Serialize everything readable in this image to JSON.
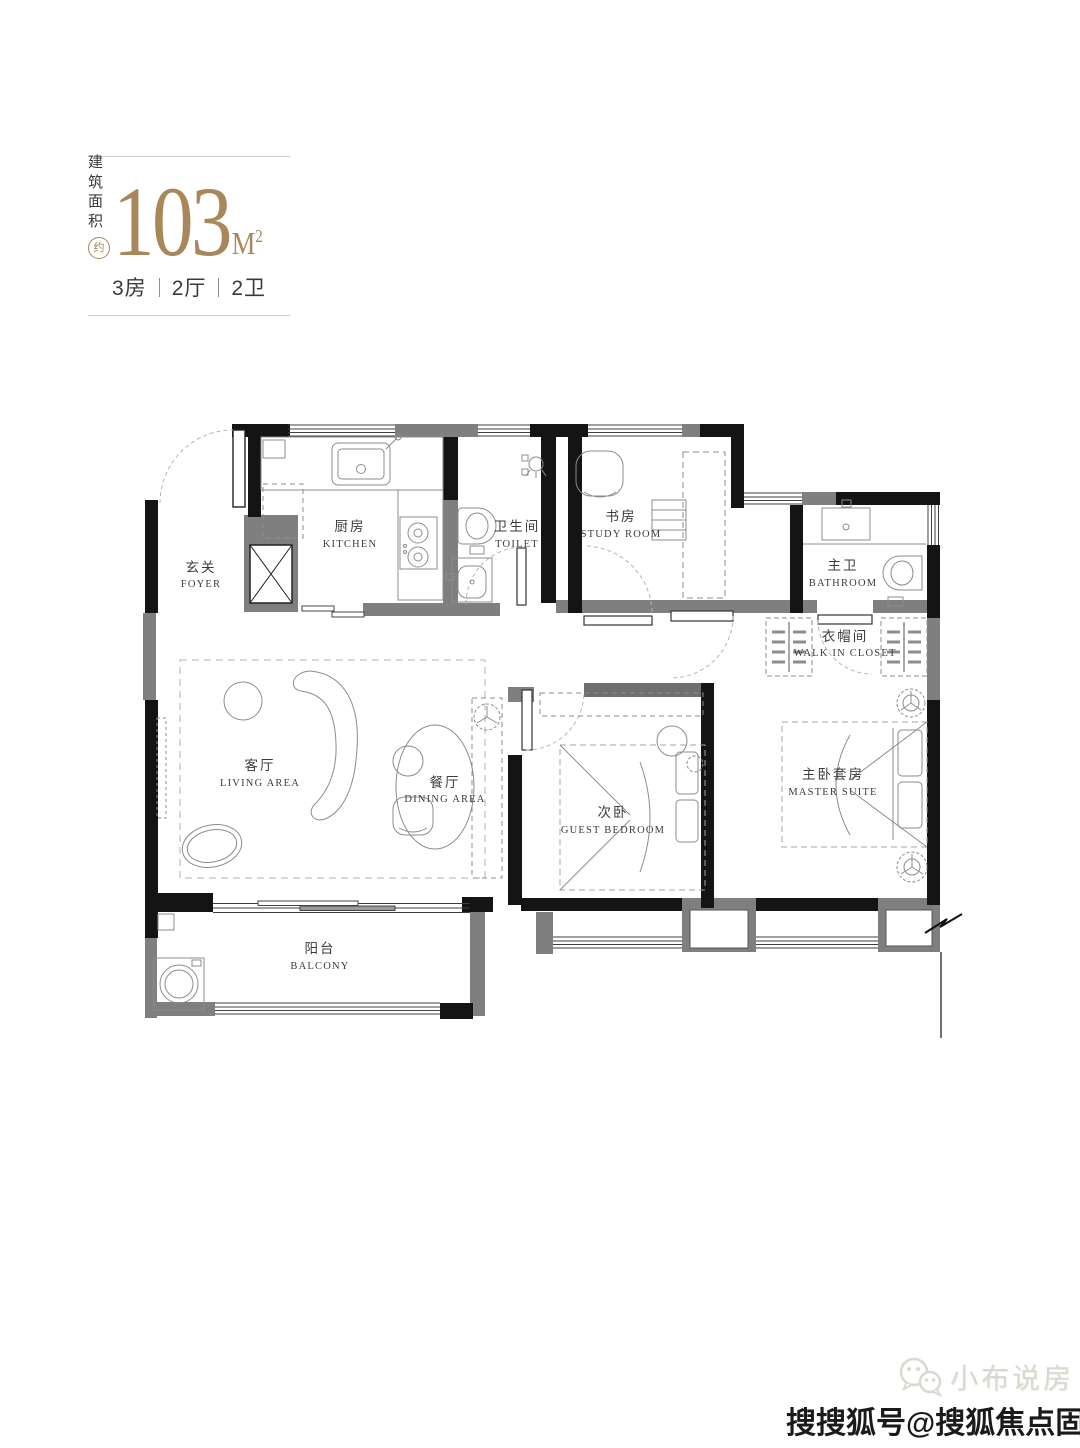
{
  "header": {
    "area_label_line1": "建筑",
    "area_label_line2": "面积",
    "approx_badge": "约",
    "area_value": "103",
    "area_unit": "M",
    "area_unit_exp": "2",
    "spec": {
      "rooms": "3房",
      "halls": "2厅",
      "baths": "2卫"
    }
  },
  "rooms": {
    "foyer": {
      "cn": "玄关",
      "en": "FOYER"
    },
    "kitchen": {
      "cn": "厨房",
      "en": "KITCHEN"
    },
    "toilet": {
      "cn": "卫生间",
      "en": "TOILET"
    },
    "study": {
      "cn": "书房",
      "en": "STUDY ROOM"
    },
    "master_bath": {
      "cn": "主卫",
      "en": "BATHROOM"
    },
    "closet": {
      "cn": "衣帽间",
      "en": "WALK IN CLOSET"
    },
    "living": {
      "cn": "客厅",
      "en": "LIVING AREA"
    },
    "dining": {
      "cn": "餐厅",
      "en": "DINING AREA"
    },
    "guest": {
      "cn": "次卧",
      "en": "GUEST BEDROOM"
    },
    "master": {
      "cn": "主卧套房",
      "en": "MASTER SUITE"
    },
    "balcony": {
      "cn": "阳台",
      "en": "BALCONY"
    }
  },
  "watermark": {
    "wechat_name": "小布说房",
    "account_line": "搜搜狐号@搜狐焦点固安站"
  },
  "colors": {
    "gold": "#a8875a",
    "wall_black": "#141414",
    "wall_gray": "#7f7f7f",
    "furniture_line": "#8c8c8c",
    "text_dark": "#3c3c3c"
  }
}
